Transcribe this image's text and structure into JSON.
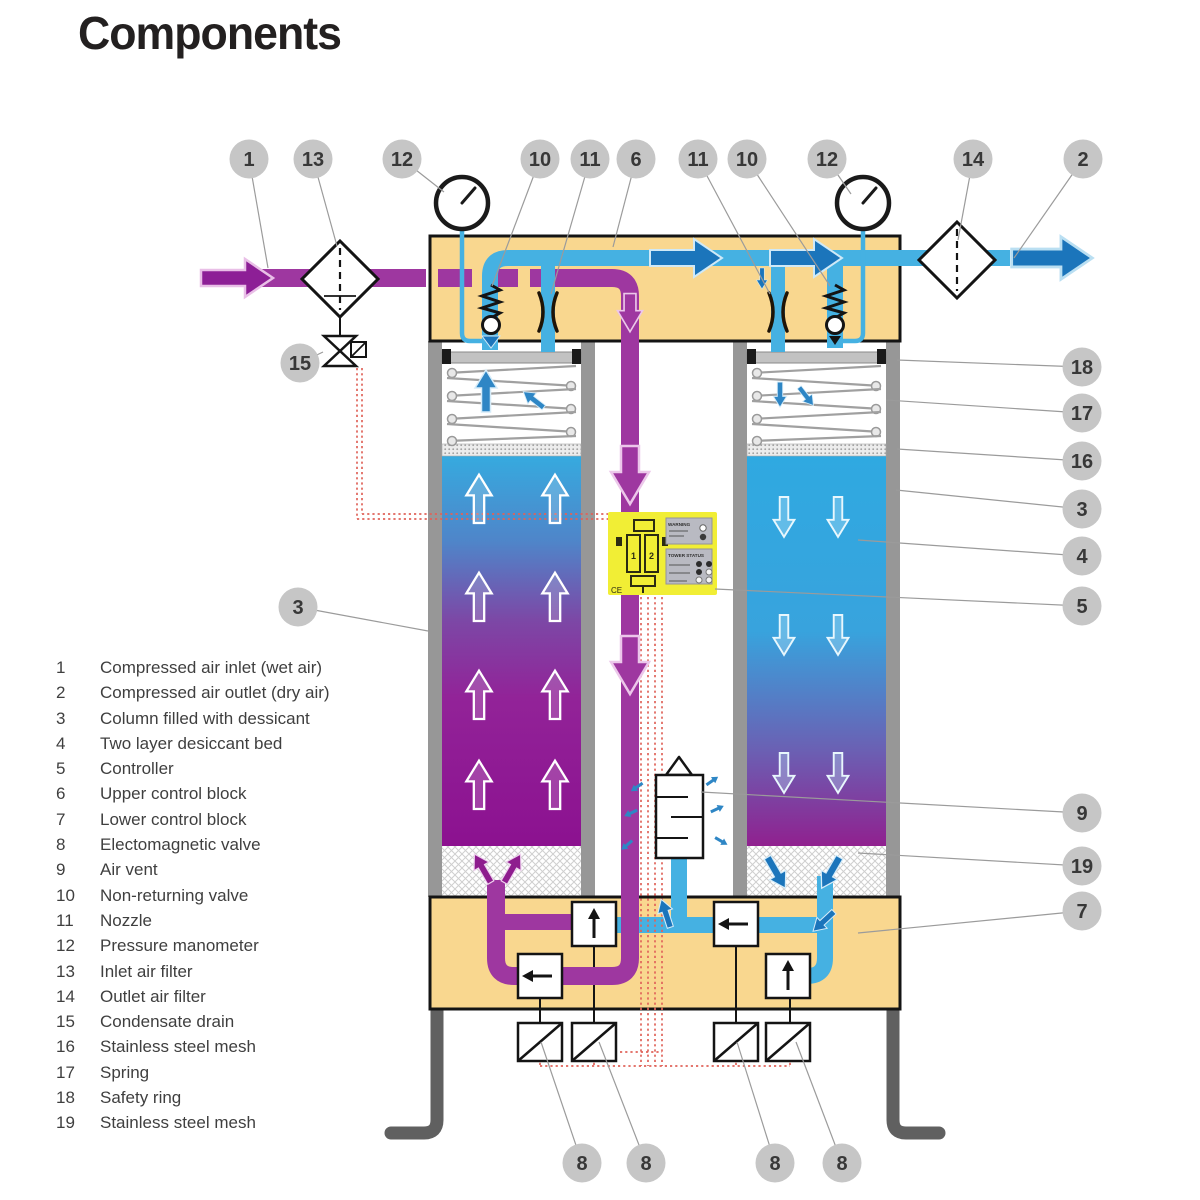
{
  "title": "Components",
  "legend": {
    "items": [
      {
        "num": "1",
        "label": "Compressed air inlet (wet air)"
      },
      {
        "num": "2",
        "label": "Compressed air outlet (dry air)"
      },
      {
        "num": "3",
        "label": "Column filled with dessicant"
      },
      {
        "num": "4",
        "label": "Two layer desiccant bed"
      },
      {
        "num": "5",
        "label": "Controller"
      },
      {
        "num": "6",
        "label": "Upper control block"
      },
      {
        "num": "7",
        "label": "Lower control block"
      },
      {
        "num": "8",
        "label": "Electomagnetic valve"
      },
      {
        "num": "9",
        "label": "Air vent"
      },
      {
        "num": "10",
        "label": "Non-returning valve"
      },
      {
        "num": "11",
        "label": "Nozzle"
      },
      {
        "num": "12",
        "label": "Pressure manometer"
      },
      {
        "num": "13",
        "label": "Inlet air filter"
      },
      {
        "num": "14",
        "label": "Outlet air filter"
      },
      {
        "num": "15",
        "label": "Condensate drain"
      },
      {
        "num": "16",
        "label": "Stainless steel mesh"
      },
      {
        "num": "17",
        "label": "Spring"
      },
      {
        "num": "18",
        "label": "Safety ring"
      },
      {
        "num": "19",
        "label": "Stainless steel mesh"
      }
    ]
  },
  "callouts": [
    {
      "n": "1",
      "x": 249,
      "y": 159,
      "tx": 268,
      "ty": 268
    },
    {
      "n": "13",
      "x": 313,
      "y": 159,
      "tx": 337,
      "ty": 246
    },
    {
      "n": "12",
      "x": 402,
      "y": 159,
      "tx": 444,
      "ty": 192
    },
    {
      "n": "10",
      "x": 540,
      "y": 159,
      "tx": 492,
      "ty": 286
    },
    {
      "n": "11",
      "x": 590,
      "y": 159,
      "tx": 551,
      "ty": 294
    },
    {
      "n": "6",
      "x": 636,
      "y": 159,
      "tx": 613,
      "ty": 247
    },
    {
      "n": "11",
      "x": 698,
      "y": 159,
      "tx": 770,
      "ty": 294
    },
    {
      "n": "10",
      "x": 747,
      "y": 159,
      "tx": 830,
      "ty": 286
    },
    {
      "n": "12",
      "x": 827,
      "y": 159,
      "tx": 851,
      "ty": 194
    },
    {
      "n": "14",
      "x": 973,
      "y": 159,
      "tx": 958,
      "ty": 240
    },
    {
      "n": "2",
      "x": 1083,
      "y": 159,
      "tx": 1014,
      "ty": 258
    },
    {
      "n": "15",
      "x": 300,
      "y": 363,
      "tx": 323,
      "ty": 352
    },
    {
      "n": "3",
      "x": 298,
      "y": 607,
      "tx": 428,
      "ty": 631
    },
    {
      "n": "18",
      "x": 1082,
      "y": 367,
      "tx": 897,
      "ty": 360
    },
    {
      "n": "17",
      "x": 1082,
      "y": 413,
      "tx": 886,
      "ty": 400
    },
    {
      "n": "16",
      "x": 1082,
      "y": 461,
      "tx": 897,
      "ty": 449
    },
    {
      "n": "3",
      "x": 1082,
      "y": 509,
      "tx": 896,
      "ty": 490
    },
    {
      "n": "4",
      "x": 1082,
      "y": 556,
      "tx": 858,
      "ty": 540
    },
    {
      "n": "5",
      "x": 1082,
      "y": 606,
      "tx": 715,
      "ty": 589
    },
    {
      "n": "9",
      "x": 1082,
      "y": 813,
      "tx": 701,
      "ty": 792
    },
    {
      "n": "19",
      "x": 1082,
      "y": 866,
      "tx": 858,
      "ty": 853
    },
    {
      "n": "7",
      "x": 1082,
      "y": 911,
      "tx": 858,
      "ty": 933
    },
    {
      "n": "8",
      "x": 582,
      "y": 1163,
      "tx": 541,
      "ty": 1042
    },
    {
      "n": "8",
      "x": 646,
      "y": 1163,
      "tx": 599,
      "ty": 1042
    },
    {
      "n": "8",
      "x": 775,
      "y": 1163,
      "tx": 737,
      "ty": 1042
    },
    {
      "n": "8",
      "x": 842,
      "y": 1163,
      "tx": 796,
      "ty": 1042
    }
  ],
  "controller": {
    "warning_label": "WARNING",
    "status_label": "TOWER STATUS",
    "ce_label": "CE",
    "tower1": "1",
    "tower2": "2"
  },
  "colors": {
    "purple": "#9e37a0",
    "purple-dark": "#8d1f96",
    "blue": "#45b1e2",
    "blue-dark": "#1b75bb",
    "tan": "#f9d78f",
    "yellow": "#f1ee35",
    "callout": "#c6c6c6",
    "wire": "#e0635a"
  }
}
